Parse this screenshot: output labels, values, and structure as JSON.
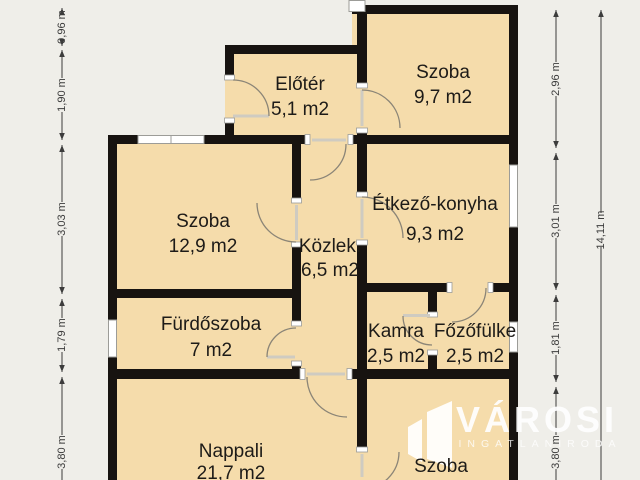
{
  "floorplan": {
    "rooms": [
      {
        "name": "Előtér",
        "area": "5,1 m2"
      },
      {
        "name": "Szoba",
        "area": "9,7 m2"
      },
      {
        "name": "Szoba",
        "area": "12,9 m2"
      },
      {
        "name": "Étkező-konyha",
        "area": "9,3 m2"
      },
      {
        "name": "Közlek.",
        "area": "6,5 m2"
      },
      {
        "name": "Fürdőszoba",
        "area": "7 m2"
      },
      {
        "name": "Kamra",
        "area": "2,5 m2"
      },
      {
        "name": "Főzőfülke",
        "area": "2,5 m2"
      },
      {
        "name": "Nappali",
        "area": "21,7 m2"
      },
      {
        "name": "Szoba",
        "area": "12,75 m2"
      }
    ],
    "dimensions": {
      "left": [
        "0,96 m",
        "1,90 m",
        "3,03 m",
        "1,79 m",
        "3,80 m"
      ],
      "right": [
        "2,96 m",
        "3,01 m",
        "1,81 m",
        "3,80 m"
      ],
      "total": "14,11 m"
    },
    "watermark": {
      "brand": "VÁROSI",
      "tagline": "INGATLANIRODA"
    },
    "colors": {
      "background": "#efeee9",
      "room_fill": "#f5dcab",
      "wall": "#171310"
    }
  }
}
